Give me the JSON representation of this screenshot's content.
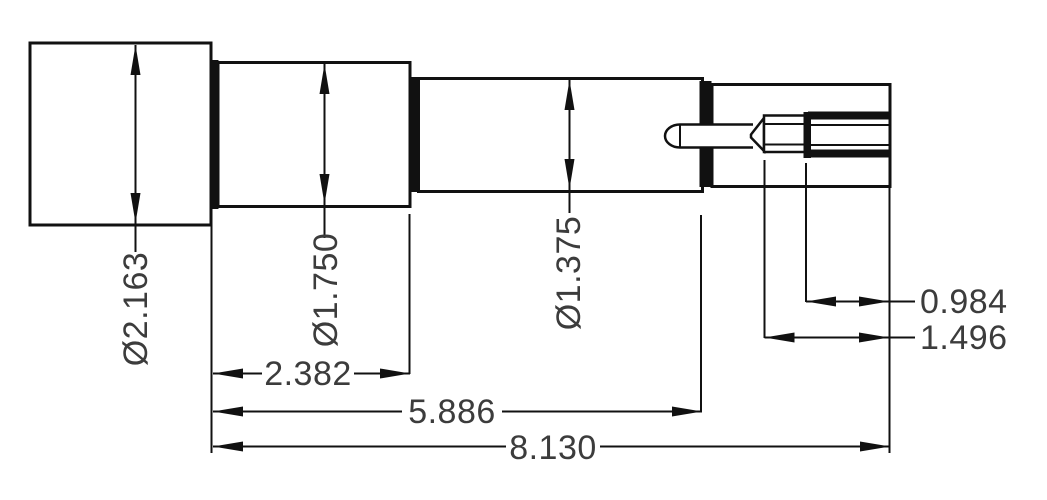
{
  "drawing": {
    "type": "engineering-dimension-drawing",
    "subject": "stepped cylindrical shaft assembly, side view",
    "background_color": "#ffffff",
    "line_color": "#111111",
    "text_color": "#3c3c3c",
    "dimensions": {
      "diameters": [
        {
          "label": "Ø2.163"
        },
        {
          "label": "Ø1.750"
        },
        {
          "label": "Ø1.375"
        }
      ],
      "lengths": [
        {
          "label": "2.382"
        },
        {
          "label": "5.886"
        },
        {
          "label": "8.130"
        },
        {
          "label": "0.984"
        },
        {
          "label": "1.496"
        }
      ]
    }
  }
}
